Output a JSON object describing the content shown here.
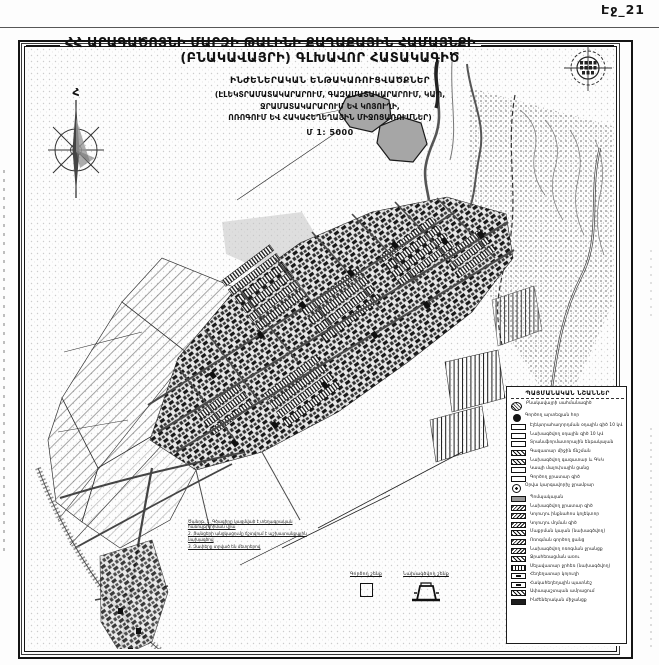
{
  "page": {
    "label": "Էջ_21"
  },
  "title": {
    "line1": "ՀՀ ԱՐԱԳԱԾՈՏՆԻ ՄԱՐԶԻ ԹԱԼԻՆԻ ՔԱՂԱՔԱՅԻՆ ՀԱՄԱՅՆՔԻ",
    "line2": "(ԲՆԱԿԱՎԱՅՐԻ) ԳԼԽԱՎՈՐ ՀԱՏԱԿԱԳԻԾ"
  },
  "subtitle": {
    "line1": "ԻՆԺԵՆԵՐԱԿԱՆ ԵՆԹԱԿԱՌՈՒՑՎԱԾՔՆԵՐ",
    "line2": "(ԷԼԵԿՏՐԱՄԱՏԱԿԱՐԱՐՈՒՄ, ԳԱԶԱՄԱՏԱԿԱՐԱՐՈՒՄ, ԿԱՊ,",
    "line3": "ՋՐԱՄԱՏԱԿԱՐԱՐՈՒՄ ԵՎ ԿՈՅՈՒՂԻ,",
    "line4": "ՈՌՈԳՈՒՄ ԵՎ ՀԱԿԱՀԵՂԵՂԱՅԻՆ ՄԻՋՈՑԱՌՈՒՄՆԵՐ)",
    "scale": "Մ 1: 5000"
  },
  "compass": {
    "north_label": "Հ"
  },
  "legend": {
    "header": "ՊԱՅՄԱՆԱԿԱՆ ՆՇԱՆՆԵՐ",
    "items": [
      {
        "symbol": "hatch-blob",
        "label": "Բնակավայրի սահմանագիծ"
      },
      {
        "symbol": "dark-circle",
        "label": "Գործող արտեզյան հոր"
      },
      {
        "symbol": "rect-outline",
        "label": "Էլեկտրահաղորդման օդային գիծ 10 կՎ"
      },
      {
        "symbol": "rect-outline",
        "label": "Նախագծվող օդային գիծ 10 կՎ"
      },
      {
        "symbol": "rect-outline",
        "label": "Տրանսֆորմատորային ենթակայան"
      },
      {
        "symbol": "rect-hatch",
        "label": "Գազատար միջին ճնշման"
      },
      {
        "symbol": "rect-hatch",
        "label": "Նախագծվող գազատար և ԳԿԿ"
      },
      {
        "symbol": "rect-outline",
        "label": "Կապի մալուխային ցանց"
      },
      {
        "symbol": "rect-outline",
        "label": "Գործող ջրատար գիծ"
      },
      {
        "symbol": "gear-circle",
        "label": "Օրվա կարգավորիչ ջրամբար"
      },
      {
        "symbol": "rect-gray",
        "label": "Պոմպակայան"
      },
      {
        "symbol": "rect-hatch2",
        "label": "Նախագծվող ջրատար գիծ"
      },
      {
        "symbol": "rect-hatch2",
        "label": "Կոյուղու ինքնահոս կոլեկտոր"
      },
      {
        "symbol": "rect-hatch2",
        "label": "Կոյուղու մղման գիծ"
      },
      {
        "symbol": "rect-hatch",
        "label": "Մաքրման կայան (նախագծվող)"
      },
      {
        "symbol": "rect-hatch2",
        "label": "Ոռոգման գործող ցանց"
      },
      {
        "symbol": "rect-hatch2",
        "label": "Նախագծվող ոռոգման ջրանցք"
      },
      {
        "symbol": "rect-hatch",
        "label": "Ջրահեռացման առու"
      },
      {
        "symbol": "rect-vlines",
        "label": "Սելավատար ջրհեռ (նախագծվող)"
      },
      {
        "symbol": "rect-inner",
        "label": "Հեղեղատար կոյուղի"
      },
      {
        "symbol": "rect-inner",
        "label": "Հակահեղեղային պատնեշ"
      },
      {
        "symbol": "rect-hatch",
        "label": "Ափապաշտպան ամրացում"
      },
      {
        "symbol": "rect-dark",
        "label": "Ինժեներական միջանցք"
      }
    ]
  },
  "notes": [
    "Ծանոթ. 1. Գծագիրը կազմված է տեղագրական հանույթի հիման վրա",
    "2. Ցանցերի անցկացումը ճշտվում է աշխատանքային նախագծով",
    "3. Չափերը տրված են մետրերով"
  ],
  "footer": {
    "symbols": [
      {
        "label": "Գործող շենք"
      },
      {
        "label": "Նախագծվող շենք"
      }
    ]
  },
  "colors": {
    "paper": "#fdfdfd",
    "ink": "#111111",
    "reservoir_gray": "#a6a6a6",
    "road_gray": "#4a4a4a"
  }
}
